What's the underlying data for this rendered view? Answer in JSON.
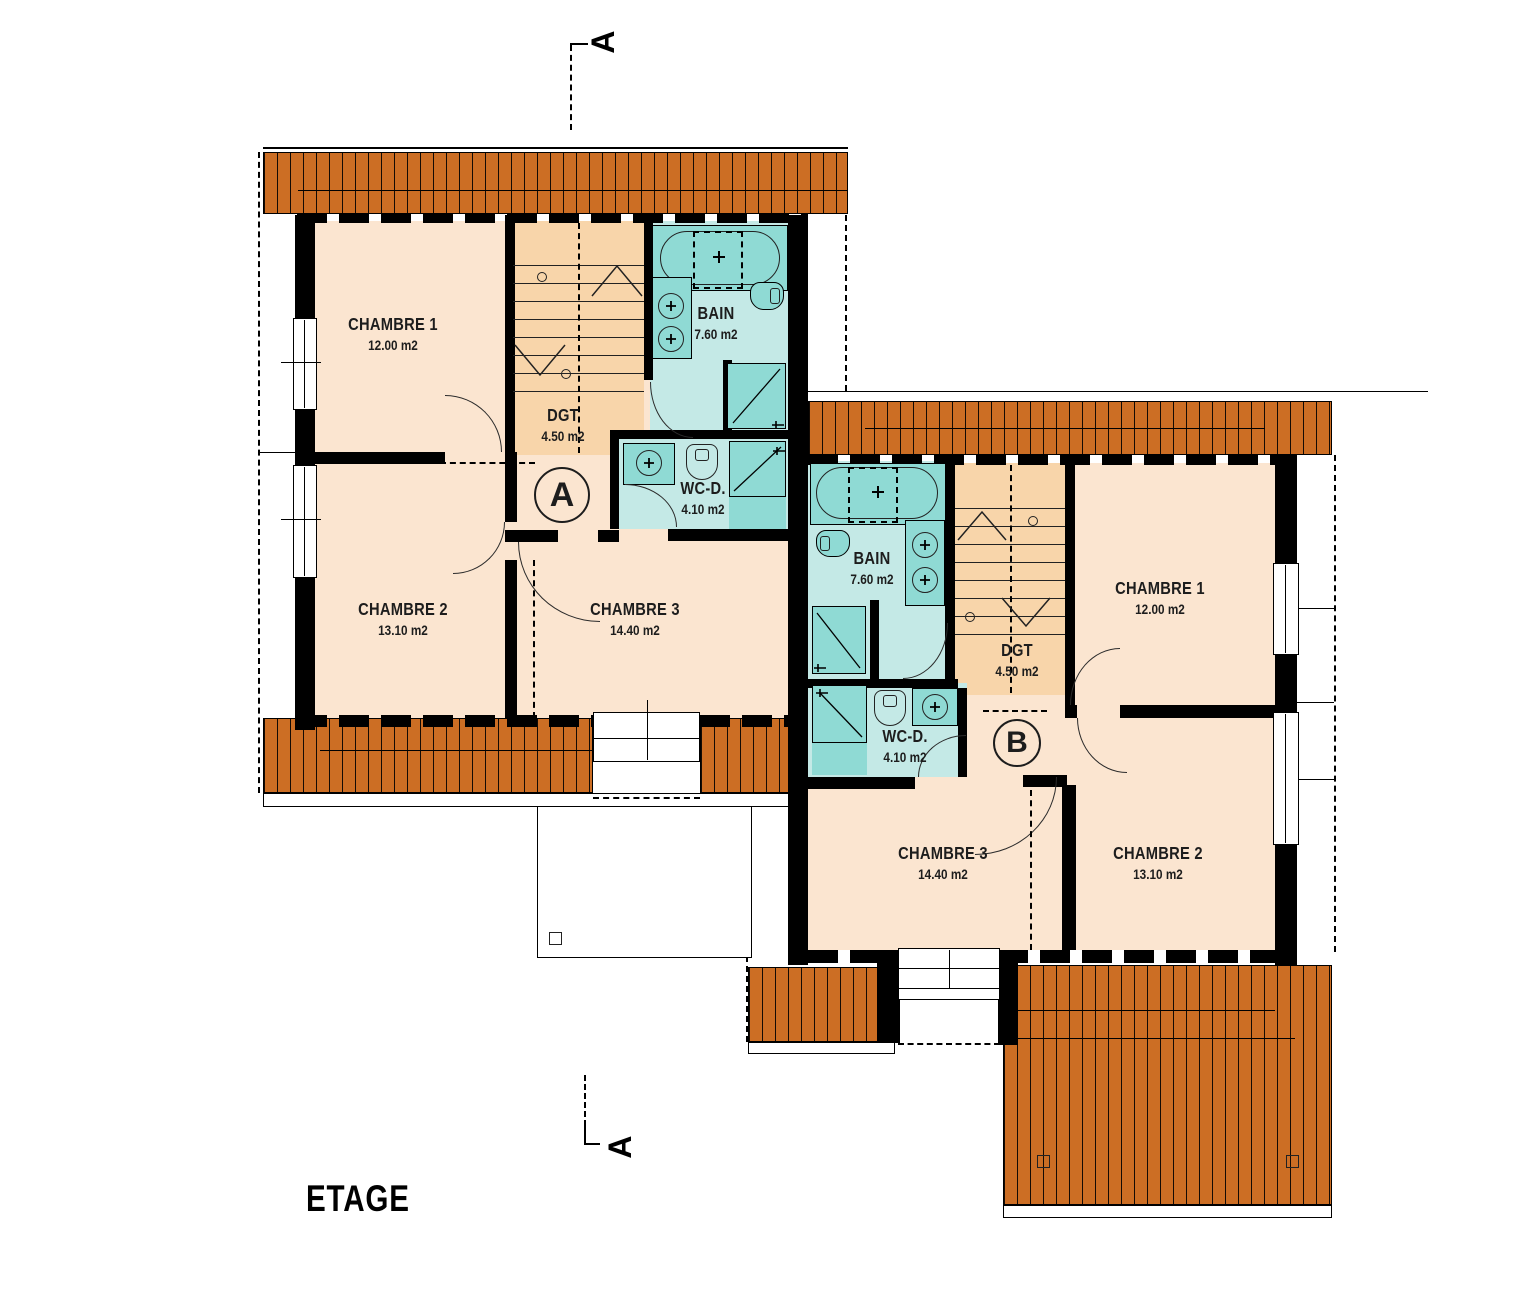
{
  "title": "ETAGE",
  "section": {
    "top_label": "A",
    "bottom_label": "A"
  },
  "colors": {
    "roof": "#CC6E24",
    "room": "#FBE5D0",
    "stairs": "#F8D5AA",
    "bathFloor": "#C4E9E6",
    "bathFix": "#8FDAD4"
  },
  "units": [
    {
      "badge": "A",
      "rooms": {
        "chambre1": {
          "name": "CHAMBRE 1",
          "area": "12.00 m2"
        },
        "chambre2": {
          "name": "CHAMBRE 2",
          "area": "13.10 m2"
        },
        "chambre3": {
          "name": "CHAMBRE 3",
          "area": "14.40 m2"
        },
        "dgt": {
          "name": "DGT",
          "area": "4.50 m2"
        },
        "bain": {
          "name": "BAIN",
          "area": "7.60 m2"
        },
        "wcd": {
          "name": "WC-D.",
          "area": "4.10 m2"
        }
      }
    },
    {
      "badge": "B",
      "rooms": {
        "chambre1": {
          "name": "CHAMBRE 1",
          "area": "12.00 m2"
        },
        "chambre2": {
          "name": "CHAMBRE 2",
          "area": "13.10 m2"
        },
        "chambre3": {
          "name": "CHAMBRE 3",
          "area": "14.40 m2"
        },
        "dgt": {
          "name": "DGT",
          "area": "4.50 m2"
        },
        "bain": {
          "name": "BAIN",
          "area": "7.60 m2"
        },
        "wcd": {
          "name": "WC-D.",
          "area": "4.10 m2"
        }
      }
    }
  ]
}
